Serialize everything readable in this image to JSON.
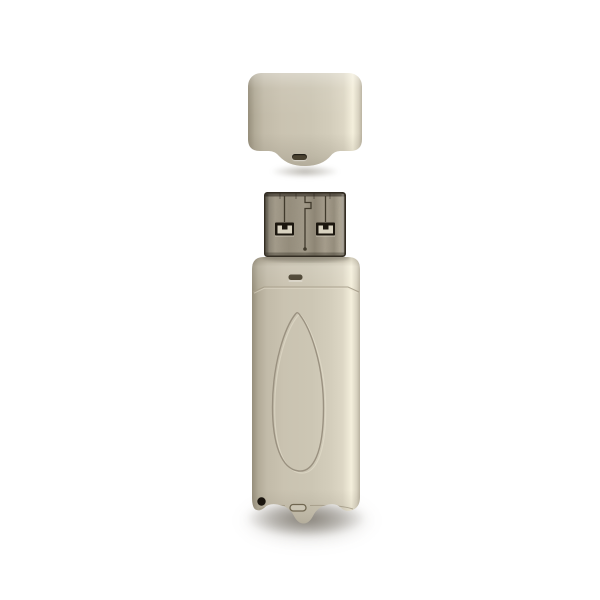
{
  "scene": {
    "description": "Beige USB flash drive shown vertically on a white background with its cap removed and placed above the exposed USB-A connector",
    "background_color": "#ffffff"
  },
  "device": {
    "cap": {
      "title": "USB drive cap",
      "base_color": "#cac3b1",
      "highlight_color": "#f4efdc",
      "shade_color": "#968e7b",
      "slot_color": "#4a4231"
    },
    "connector": {
      "title": "USB Type-A metal connector",
      "metal_color": "#9a9281",
      "edge_color": "#332d23",
      "hole_color": "#1c170f",
      "contact_color": "#d8d2c0",
      "trace_color": "#403a2c"
    },
    "body": {
      "title": "USB drive body",
      "base_color": "#ccc6b4",
      "highlight_color": "#f4efdc",
      "shade_color": "#968e7b",
      "emboss_line_color": "#9a9180",
      "ridge_line_color": "#a69d89",
      "neck_slot_color": "#49412f",
      "led_hole_color": "#140f09"
    },
    "shadow_color": "#463f32"
  }
}
